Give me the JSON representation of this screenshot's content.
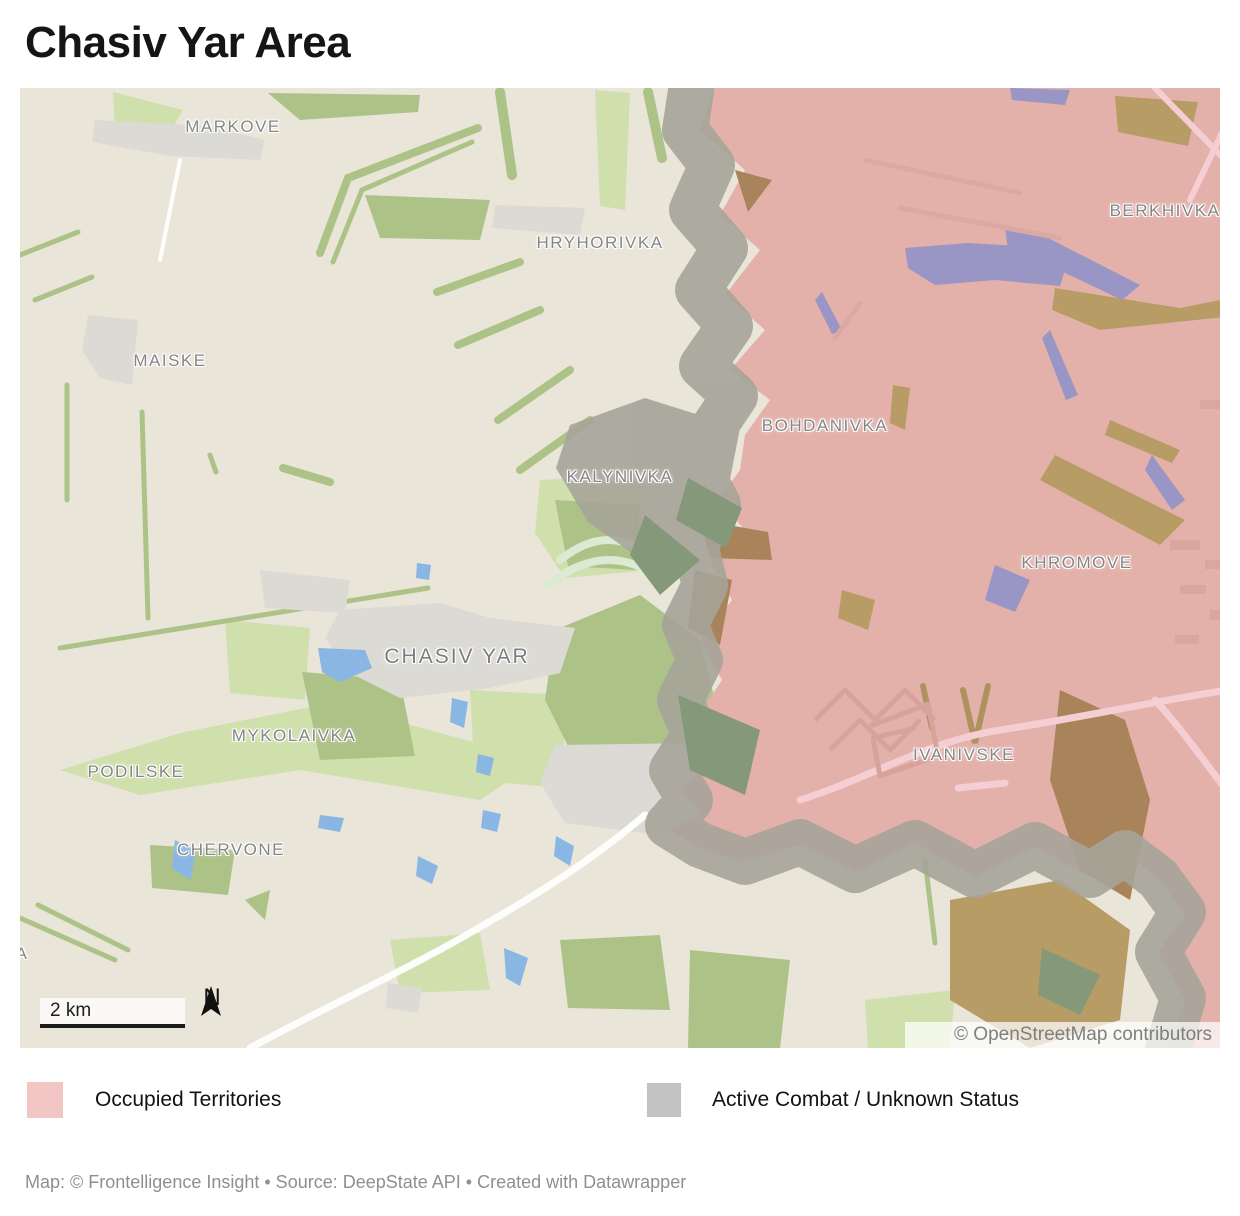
{
  "title": "Chasiv Yar Area",
  "map": {
    "place_labels": [
      {
        "text": "MARKOVE"
      },
      {
        "text": "HRYHORIVKA"
      },
      {
        "text": "BERKHIVKA"
      },
      {
        "text": "MAISKE"
      },
      {
        "text": "BOHDANIVKA"
      },
      {
        "text": "KALYNIVKA"
      },
      {
        "text": "KHROMOVE"
      },
      {
        "text": "CHASIV YAR"
      },
      {
        "text": "MYKOLAIVKA"
      },
      {
        "text": "PODILSKE"
      },
      {
        "text": "CHERVONE"
      },
      {
        "text": "IVANIVSKE"
      },
      {
        "text": "A"
      }
    ],
    "scale_bar": {
      "label": "2 km"
    },
    "compass": {
      "label": "N"
    },
    "attribution": "© OpenStreetMap contributors",
    "colors": {
      "map_background": "#e9e5d9",
      "occupied": "#e3b1aa",
      "combat": "#a6a499",
      "forest_light": "#cfe0ad",
      "forest_medium": "#adc287",
      "water": "#89b6e3",
      "water_occupied": "#9995c4",
      "fields_occupied": "#b79c66"
    }
  },
  "legend": {
    "items": [
      {
        "label": "Occupied Territories",
        "color": "#f3c6c6"
      },
      {
        "label": "Active Combat / Unknown Status",
        "color": "#c2c2c2"
      }
    ]
  },
  "footer": "Map: © Frontelligence Insight • Source: DeepState API • Created with Datawrapper"
}
